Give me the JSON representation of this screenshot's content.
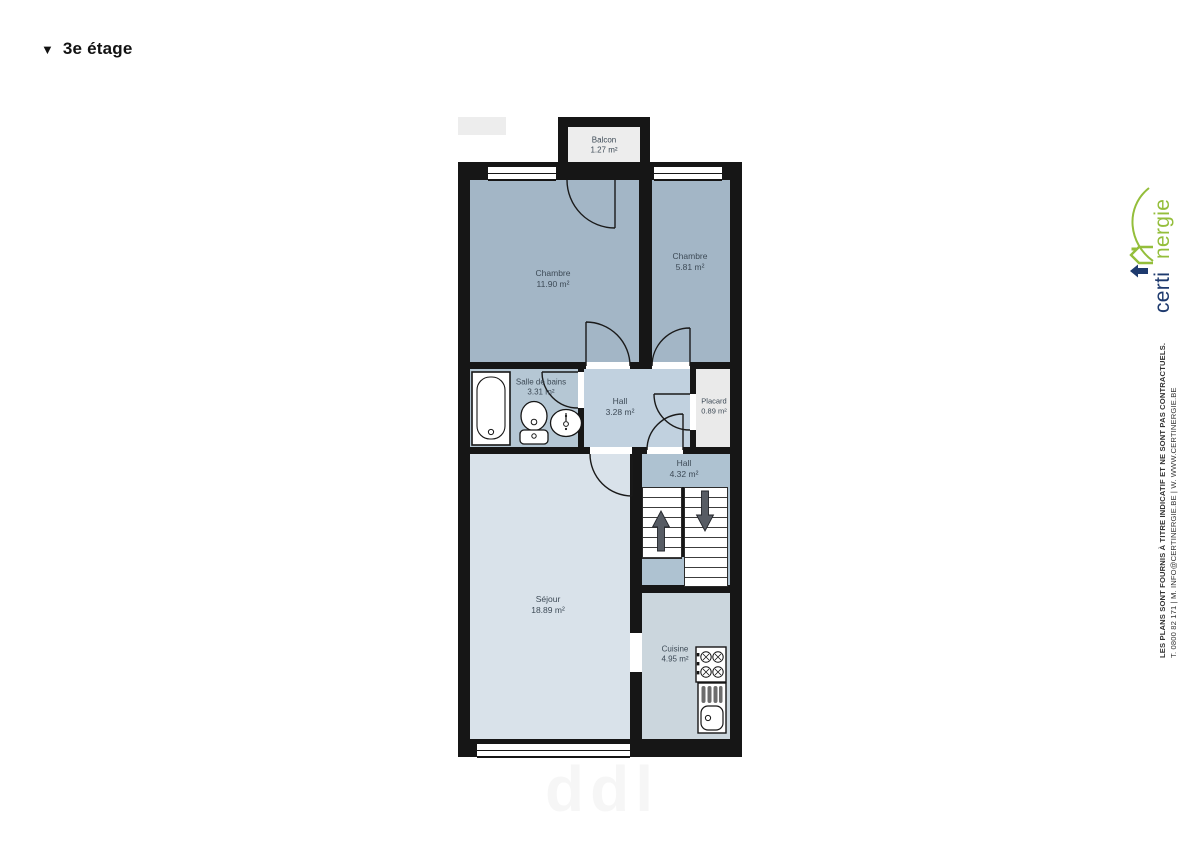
{
  "page": {
    "title": "3e étage",
    "title_marker": "▼"
  },
  "floorplan": {
    "rooms": [
      {
        "id": "balcon",
        "label": "Balcon",
        "area": "1.27 m²"
      },
      {
        "id": "chambre-1",
        "label": "Chambre",
        "area": "11.90 m²"
      },
      {
        "id": "chambre-2",
        "label": "Chambre",
        "area": "5.81 m²"
      },
      {
        "id": "salle-de-bains",
        "label": "Salle de bains",
        "area": "3.31 m²"
      },
      {
        "id": "hall-1",
        "label": "Hall",
        "area": "3.28 m²"
      },
      {
        "id": "placard",
        "label": "Placard",
        "area": "0.89 m²"
      },
      {
        "id": "hall-2",
        "label": "Hall",
        "area": "4.32 m²"
      },
      {
        "id": "sejour",
        "label": "Séjour",
        "area": "18.89 m²"
      },
      {
        "id": "cuisine",
        "label": "Cuisine",
        "area": "4.95 m²"
      }
    ],
    "colors": {
      "wall": "#161616",
      "chambre_fill": "#a3b6c6",
      "bathroom_fill": "#b5c7d4",
      "hall1_fill": "#c1d1df",
      "hall2_fill": "#aec2d1",
      "sejour_fill": "#d9e2ea",
      "cuisine_fill": "#cbd6dd",
      "placard_fill": "#eaeaea",
      "balcony_fill": "#ededed"
    }
  },
  "branding": {
    "logo_blue": "certi",
    "logo_green": "nergie",
    "logo_blue_color": "#1e3a6e",
    "logo_green_color": "#94be3b",
    "disclaimer_line1": "LES PLANS SONT FOURNIS À TITRE INDICATIF ET NE SONT PAS CONTRACTUELS.",
    "disclaimer_line2": "T. 0800 82 171 | M. INFO@CERTINERGIE.BE | W. WWW.CERTINERGIE.BE"
  },
  "watermark": {
    "text": "ddl"
  }
}
